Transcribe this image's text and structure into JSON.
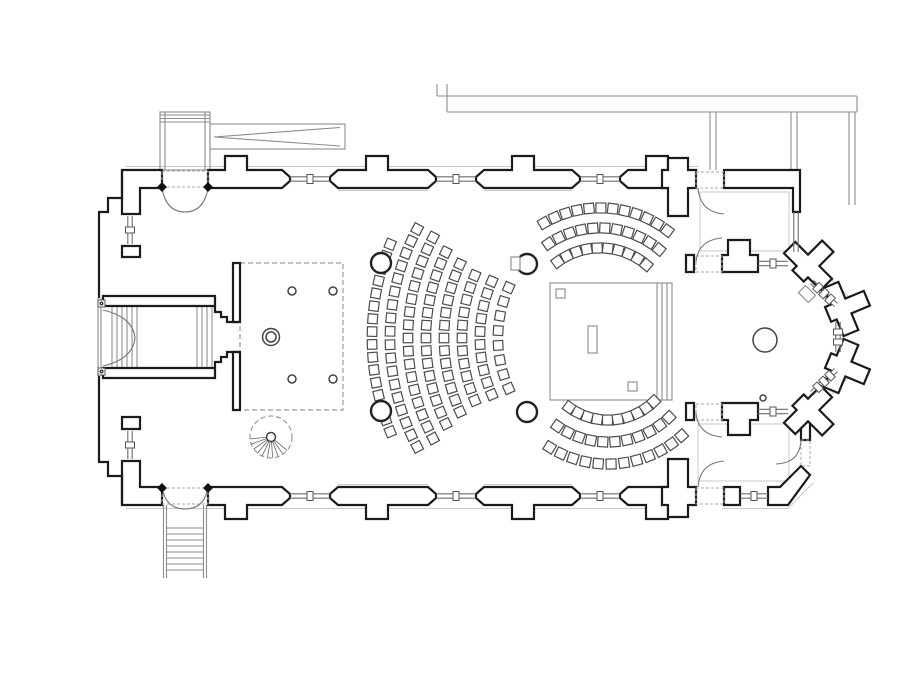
{
  "title": "church-floor-plan",
  "colors": {
    "wall": "#1b1b1b",
    "thin_line": "#8c8c8c",
    "halo": "#c8c8c8",
    "dashed": "#9b9b9b",
    "seat_stroke": "#4c4c4c"
  },
  "plan": {
    "seating": [
      {
        "target": "nave-seating",
        "type": "fan-west",
        "cx": 622,
        "cy": 338,
        "seat": 9.5,
        "rows": [
          {
            "r": 250,
            "a0": -22,
            "a1": 22,
            "n": 16
          },
          {
            "r": 232,
            "a0": -28,
            "a1": 28,
            "n": 18
          },
          {
            "r": 214,
            "a0": -28,
            "a1": 28,
            "n": 17
          },
          {
            "r": 196,
            "a0": -26,
            "a1": 26,
            "n": 15
          },
          {
            "r": 178,
            "a0": -24.5,
            "a1": 24.5,
            "n": 13
          },
          {
            "r": 160,
            "a0": -23,
            "a1": 23,
            "n": 11
          },
          {
            "r": 142,
            "a0": -23.5,
            "a1": 23.5,
            "n": 10
          },
          {
            "r": 124,
            "a0": -24,
            "a1": 24,
            "n": 8
          }
        ]
      },
      {
        "target": "choir-seating-north",
        "type": "arc-top",
        "cx": 600,
        "cy": 320,
        "seat": 10,
        "rows": [
          {
            "r": 72,
            "a0": -36,
            "a1": 40,
            "n": 10
          },
          {
            "r": 92,
            "a0": -34,
            "a1": 40,
            "n": 11
          },
          {
            "r": 112,
            "a0": -30,
            "a1": 37,
            "n": 12
          }
        ]
      },
      {
        "target": "choir-seating-south",
        "type": "arc-bottom",
        "cx": 608,
        "cy": 354,
        "seat": 10,
        "rows": [
          {
            "r": 66,
            "a0": -36,
            "a1": 44,
            "n": 10
          },
          {
            "r": 88,
            "a0": -35,
            "a1": 44,
            "n": 11
          },
          {
            "r": 110,
            "a0": -32,
            "a1": 42,
            "n": 12
          }
        ]
      }
    ],
    "columns": [
      [
        381,
        263
      ],
      [
        381,
        411
      ],
      [
        527,
        264
      ],
      [
        527,
        412
      ]
    ],
    "gallery_posts": [
      [
        292,
        291
      ],
      [
        333,
        291
      ],
      [
        292,
        379
      ],
      [
        333,
        379
      ]
    ],
    "ring_column": {
      "cx": 271,
      "cy": 337,
      "r_outer": 8.5,
      "r_inner": 5
    },
    "apse_circles": [
      {
        "cx": 765,
        "cy": 340,
        "r": 12
      },
      {
        "cx": 763,
        "cy": 398,
        "r": 3
      }
    ],
    "windows": [
      {
        "x0": 290,
        "y0": 179,
        "x1": 330,
        "y1": 179,
        "ticks": 1
      },
      {
        "x0": 436,
        "y0": 179,
        "x1": 476,
        "y1": 179,
        "ticks": 1
      },
      {
        "x0": 580,
        "y0": 179,
        "x1": 620,
        "y1": 179,
        "ticks": 1
      },
      {
        "x0": 290,
        "y0": 496,
        "x1": 330,
        "y1": 496,
        "ticks": 1
      },
      {
        "x0": 436,
        "y0": 496,
        "x1": 476,
        "y1": 496,
        "ticks": 1
      },
      {
        "x0": 580,
        "y0": 496,
        "x1": 620,
        "y1": 496,
        "ticks": 1
      },
      {
        "x0": 130,
        "y0": 216,
        "x1": 130,
        "y1": 244,
        "ticks": 1
      },
      {
        "x0": 130,
        "y0": 431,
        "x1": 130,
        "y1": 459,
        "ticks": 1
      },
      {
        "x0": 758,
        "y0": 263.5,
        "x1": 788,
        "y1": 263.5,
        "ticks": 1
      },
      {
        "x0": 758,
        "y0": 411.5,
        "x1": 788,
        "y1": 411.5,
        "ticks": 1
      },
      {
        "x0": 740,
        "y0": 496,
        "x1": 768,
        "y1": 496,
        "ticks": 1
      },
      {
        "x0": 812,
        "y0": 282,
        "x1": 836,
        "y1": 305,
        "ticks": 3
      },
      {
        "x0": 838,
        "y0": 322,
        "x1": 838,
        "y1": 352,
        "ticks": 2
      },
      {
        "x0": 836,
        "y0": 370,
        "x1": 812,
        "y1": 393,
        "ticks": 3
      },
      {
        "x0": 796,
        "y0": 212,
        "x1": 796,
        "y1": 252,
        "ticks": 0
      }
    ],
    "spiral_stair": {
      "cx": 271,
      "cy": 437,
      "r": 21,
      "hub_r": 4.5,
      "tread_angles_deg": [
        40,
        55,
        70,
        85,
        100,
        115,
        130,
        145,
        160,
        175
      ]
    },
    "south_porch_treads": {
      "x0": 166.5,
      "x1": 203.5,
      "ys": [
        528,
        534,
        540,
        546,
        552,
        558,
        564,
        570
      ]
    },
    "entry_steps_x": [
      112,
      117,
      122,
      127,
      132,
      137
    ],
    "tower_flight_x": [
      197,
      202,
      207,
      212
    ],
    "platform_step_x": [
      657,
      662,
      667
    ],
    "furniture": [
      {
        "x": 556,
        "y": 289,
        "w": 9,
        "h": 9
      },
      {
        "x": 588,
        "y": 326,
        "w": 9,
        "h": 27
      },
      {
        "x": 628,
        "y": 382,
        "w": 9,
        "h": 9
      },
      {
        "x": 511,
        "y": 257,
        "w": 9,
        "h": 13
      }
    ],
    "tilted_marker": {
      "cx": 807,
      "cy": 294,
      "w": 14,
      "h": 10,
      "angle": 45
    }
  }
}
